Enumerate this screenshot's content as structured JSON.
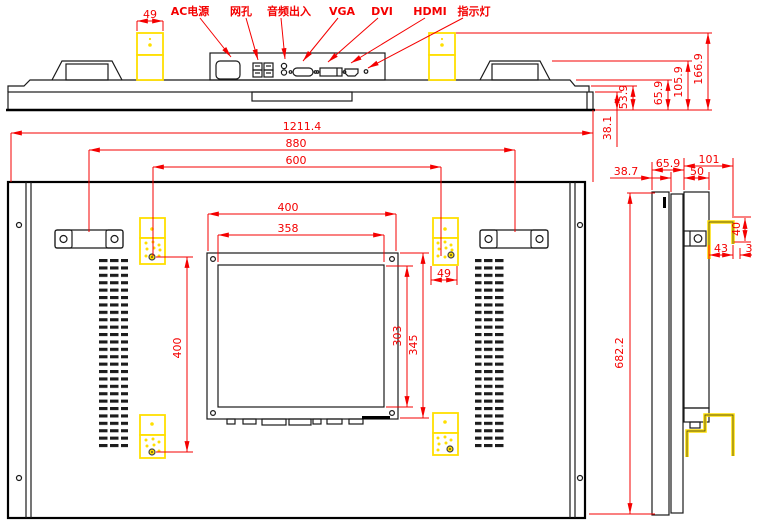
{
  "colors": {
    "dimension_red": "#f40000",
    "highlight_yellow": "#ffdf00",
    "line_black": "#000000"
  },
  "top_view": {
    "labels": {
      "ac_power": "AC电源",
      "lan": "网孔",
      "audio_io": "音频出入",
      "vga": "VGA",
      "dvi": "DVI",
      "hdmi": "HDMI",
      "indicator": "指示灯"
    },
    "dims": {
      "bracket_width": "49",
      "step": "53.9",
      "body": "65.9",
      "handle": "105.9",
      "bracket_top": "166.9",
      "bezel": "38.1"
    }
  },
  "rear_view": {
    "dims": {
      "overall_width": "1211.4",
      "handle_span": "880",
      "mount_span_h": "600",
      "panel_width": "400",
      "panel_inner_width": "358",
      "bracket_width": "49",
      "mount_span_v": "400",
      "panel_inner_height": "303",
      "panel_height": "345",
      "overall_height": "682.2"
    }
  },
  "side_view": {
    "dims": {
      "body_depth": "65.9",
      "total_depth": "101",
      "front_depth": "38.7",
      "box_depth": "50",
      "hook_height": "40",
      "hook_depth": "43",
      "hook_gap": "3"
    }
  }
}
